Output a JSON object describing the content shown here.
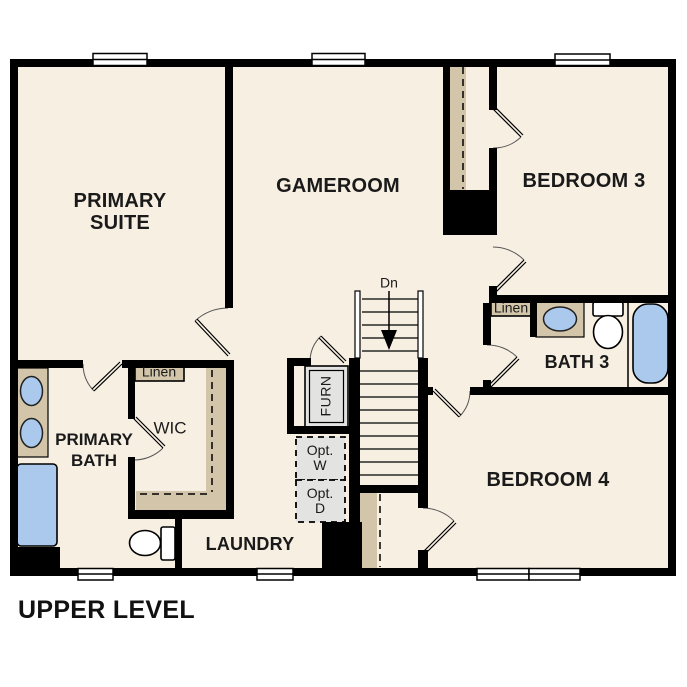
{
  "plan": {
    "title": "UPPER LEVEL",
    "labels": {
      "primary_suite": {
        "line1": "PRIMARY",
        "line2": "SUITE"
      },
      "gameroom": "GAMEROOM",
      "bedroom3": "BEDROOM 3",
      "bath3": "BATH 3",
      "bedroom4": "BEDROOM 4",
      "primary_bath": {
        "line1": "PRIMARY",
        "line2": "BATH"
      },
      "wic": "WIC",
      "laundry": "LAUNDRY",
      "linen_primary": "Linen",
      "linen_bath3": "Linen",
      "stairs_down": "Dn",
      "furnace": "FURN",
      "opt_washer": {
        "line1": "Opt.",
        "line2": "W"
      },
      "opt_dryer": {
        "line1": "Opt.",
        "line2": "D"
      }
    },
    "colors": {
      "background": "#ffffff",
      "floor": "#f7efe2",
      "wall": "#000000",
      "casework_tan": "#d3c5aa",
      "fixture_blue": "#abc9ed",
      "equipment_gray": "#e3e3e1"
    }
  }
}
